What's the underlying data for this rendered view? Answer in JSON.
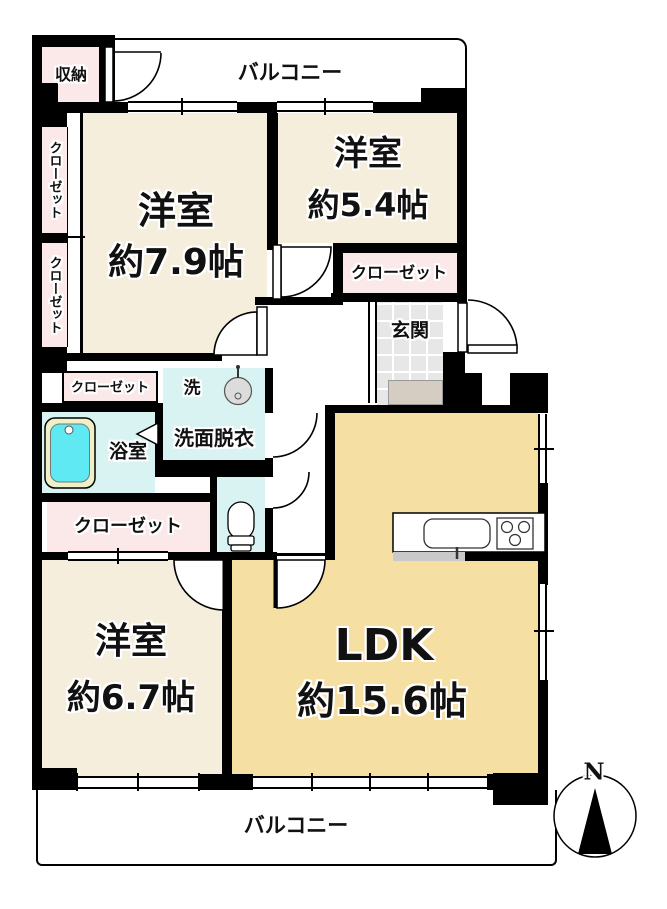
{
  "floorplan": {
    "balcony_top": "バルコニー",
    "balcony_bottom": "バルコニー",
    "storage_label": "収納",
    "closet_label": "クローゼット",
    "entrance_label": "玄関",
    "washer_label": "洗",
    "washroom_label": "洗面脱衣",
    "bathroom_label": "浴室",
    "rooms": [
      {
        "id": "western-room-7-9",
        "name": "洋室",
        "size": "約7.9帖"
      },
      {
        "id": "western-room-5-4",
        "name": "洋室",
        "size": "約5.4帖"
      },
      {
        "id": "western-room-6-7",
        "name": "洋室",
        "size": "約6.7帖"
      },
      {
        "id": "ldk",
        "name": "LDK",
        "size": "約15.6帖"
      }
    ],
    "compass_north_label": "N"
  },
  "colors": {
    "wall": "#000000",
    "room_cream": "#f5eedd",
    "ldk_yellow": "#f5dfa3",
    "closet_pink": "#fbe9e9",
    "wet_cyan": "#d9f3f3",
    "bathtub_cyan": "#5fe9f2",
    "tub_rim": "#eef0c8",
    "entrance_tile": "#e7e7e7",
    "entrance_step": "#d6cdc2"
  }
}
